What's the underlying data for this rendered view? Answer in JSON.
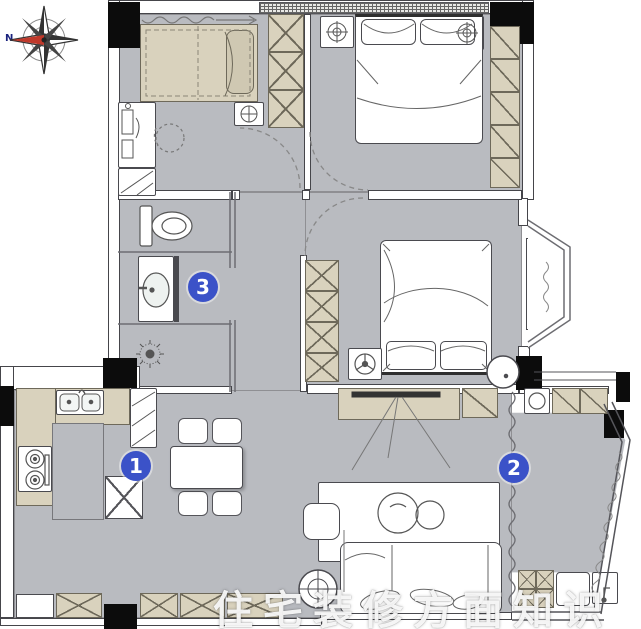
{
  "plan": {
    "type": "apartment-floor-plan",
    "compass": {
      "label": "N"
    },
    "markers": [
      {
        "label": "1"
      },
      {
        "label": "2"
      },
      {
        "label": "3"
      }
    ],
    "watermark": {
      "text": "住宅装修方面知识"
    },
    "colors": {
      "floor": "#b9bbc0",
      "furniture": "#d9d2bd",
      "wall-line": "#45454a",
      "column": "#0c0c0c",
      "marker-blue": "#3b52c8",
      "compass-red": "#c0392b",
      "background": "#ffffff"
    },
    "icons": {
      "compass": "8-point-star-rose",
      "ceiling-lamp": "circle-with-crosshair",
      "shower": "starburst",
      "toilet": "oval-with-tank",
      "basin": "oval-in-counter",
      "stove": "two-burners",
      "kitchen-sink": "double-basin",
      "fan-lamp": "circle-with-spokes",
      "floor-lamp": "circle-with-cross"
    }
  }
}
